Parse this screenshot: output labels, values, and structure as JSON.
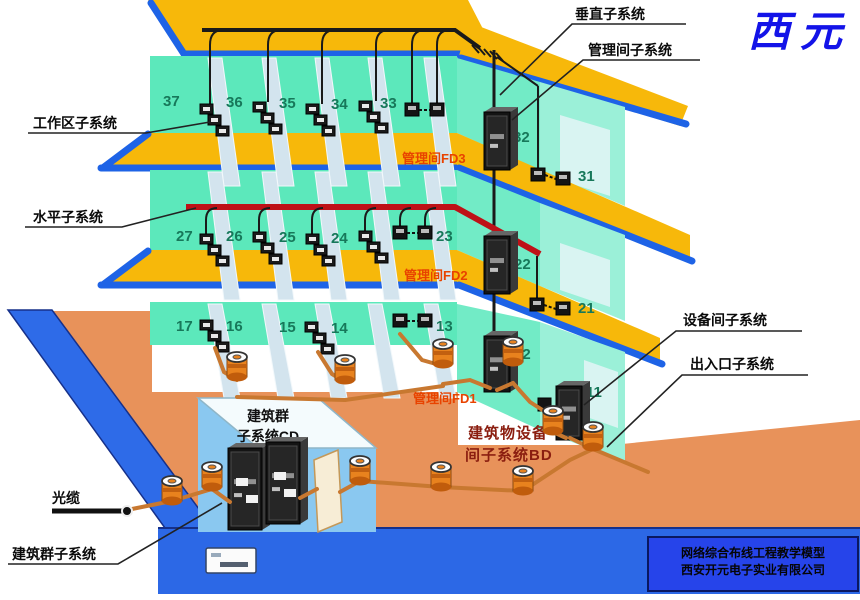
{
  "brand": {
    "logo": "西元"
  },
  "labels": {
    "vertical": "垂直子系统",
    "mgmt_room": "管理间子系统",
    "work_area": "工作区子系统",
    "horizontal": "水平子系统",
    "equipment_room": "设备间子系统",
    "entrance": "出入口子系统",
    "optical_cable": "光缆",
    "campus": "建筑群子系统"
  },
  "fd": {
    "fd3": "管理间FD3",
    "fd2": "管理间FD2",
    "fd1": "管理间FD1"
  },
  "rooms": {
    "f3": [
      "37",
      "36",
      "35",
      "34",
      "33",
      "32",
      "31"
    ],
    "f2": [
      "27",
      "26",
      "25",
      "24",
      "23",
      "22",
      "21"
    ],
    "f1": [
      "17",
      "16",
      "15",
      "14",
      "13",
      "12",
      "11"
    ]
  },
  "cd_box": {
    "line1": "建筑群",
    "line2": "子系统CD"
  },
  "bd_box": {
    "line1": "建筑物设备",
    "line2": "间子系统BD"
  },
  "footer": {
    "line1": "网络综合布线工程教学模型",
    "line2": "西安开元电子实业有限公司"
  },
  "colors": {
    "brand": "#1313e8",
    "fd_label": "#e84300",
    "bd_label": "#8b1e10",
    "red_cable": "#be1117",
    "slab_yellow": "#f7b80a",
    "wall_teal": "#5ce8bb",
    "ground_orange": "#e8925a",
    "platform_blue": "#2c68e6"
  }
}
